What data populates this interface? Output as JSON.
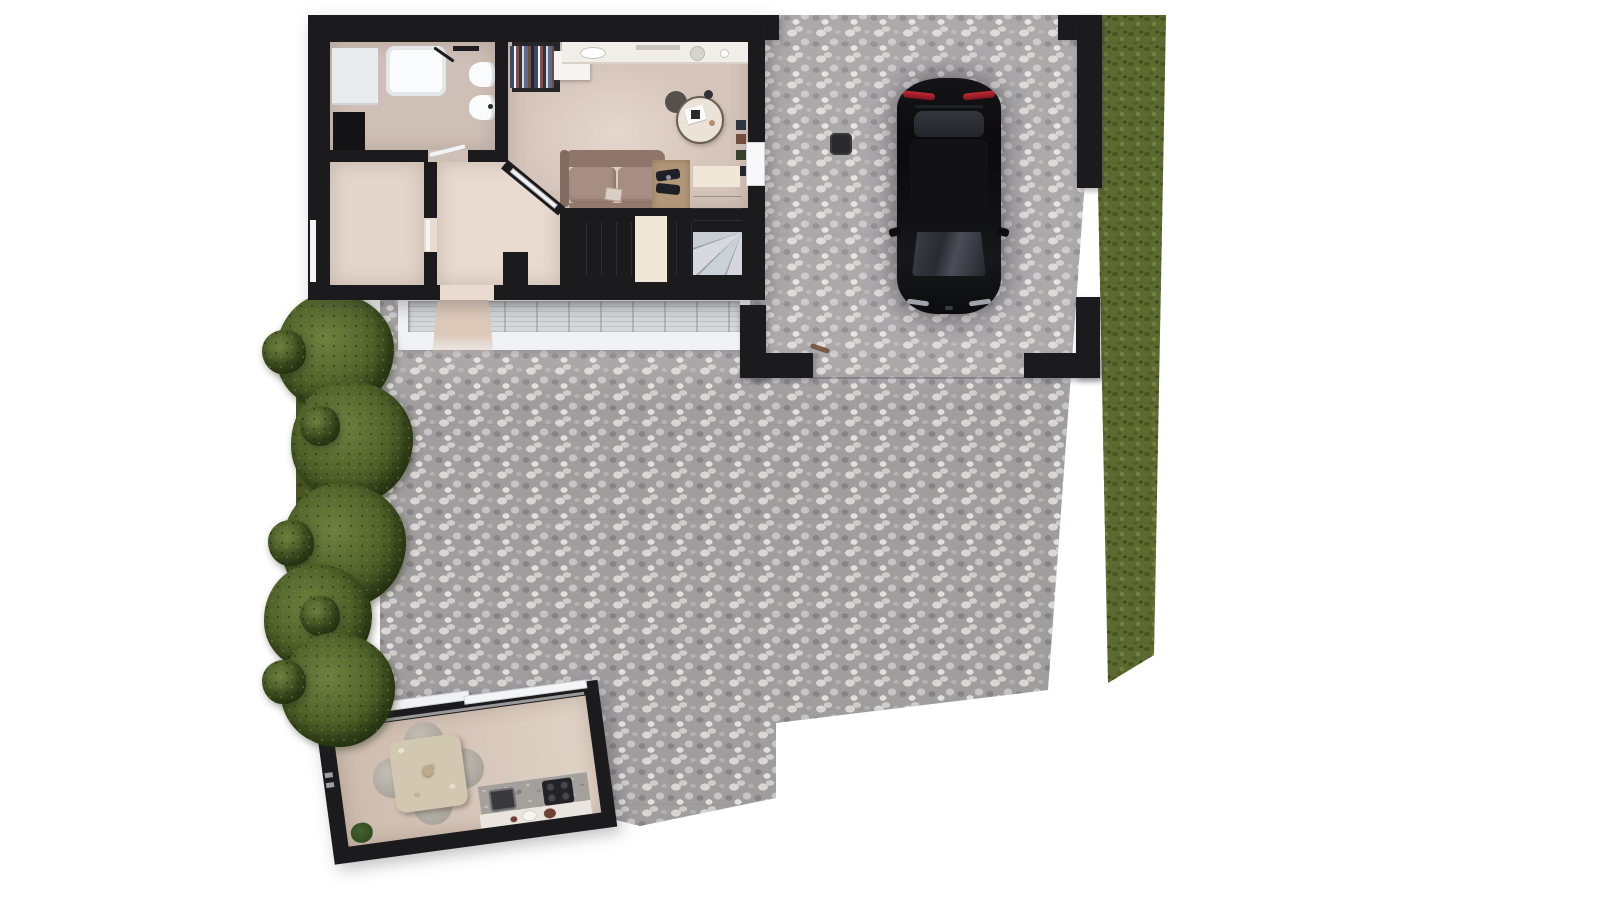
{
  "meta": {
    "kind": "3d-floor-plan-render",
    "view": "top-down",
    "canvas": {
      "width": 1600,
      "height": 900
    },
    "text_content": "none — image contains no visible text, numbers or labels"
  },
  "colors": {
    "background": "#ffffff",
    "wall": "#1b1b1d",
    "bathroomFloor": "#cfc0b7",
    "bedroomFloor": "#e4d6cb",
    "hallFloor": "#e9dbd0",
    "livingFloor": "#d6c5bb",
    "counter": "#f1ede8",
    "sofa": "#a78e83",
    "sofaBack": "#8f766c",
    "wood": "#b2977a",
    "stairLight": "#edeff2",
    "cream": "#f0e7d9",
    "terraceBorder": "#f1f2f3",
    "terraceTile": "#d6d8da",
    "paving": "#a09d9f",
    "pebbleLight": "#d9d7d5",
    "pebbleDark": "#878486",
    "grass": "#5c6a31",
    "grassDark": "#48561f",
    "grassLight": "#73823c",
    "hedge": "#4a5724",
    "bushInner": "#708040",
    "bushOuter": "#32401a",
    "carBody": "#0d0d0f",
    "tailLight": "#b3222e",
    "stoneTable": "#d2c7b0",
    "stoneTable2": "#ece3d8",
    "gardenFloor": "#e0d2c6",
    "kitchenCounter": "#a4a19d",
    "plate": "#f6f4f0",
    "bowl": "#6e4134",
    "pathBeige": "#e0ccbd"
  },
  "scene": {
    "main_house": {
      "rooms": [
        "bathroom",
        "bedroom",
        "hallway",
        "living room",
        "staircase"
      ],
      "bathroom_fixtures": [
        "bathtub with faucet",
        "toilet",
        "bidet",
        "washing machine",
        "dark vanity cabinet",
        "wall shelf"
      ],
      "living_furniture": [
        "kitchen counter with sink",
        "wardrobe with hanging clothes",
        "white island",
        "round side table with papers",
        "two-seat sofa with pillow",
        "wooden dining nook with dark chairs",
        "wall shelf with decor"
      ],
      "staircase": {
        "flights": 2,
        "winder_corner": true,
        "cream_landing_boxes": 2
      },
      "openings": [
        "front entrance door",
        "bathroom door",
        "bedroom door",
        "diagonal glass door to living room",
        "side window to carport"
      ]
    },
    "carport": {
      "corner_pillars": 4,
      "floor": "cobblestone",
      "drain_cover": 1,
      "car": {
        "color": "black",
        "type": "sedan, parked vertically",
        "details": [
          "red taillight strips",
          "rear window",
          "roof",
          "windshield",
          "side mirrors",
          "front highlights"
        ]
      }
    },
    "outdoor": {
      "terrace": {
        "finish": "grey tiles with white border",
        "doormat_path": true
      },
      "paved_courtyard": "cobble pattern with step-shaped lower boundary",
      "lawn_strip": "right edge, tapering toward bottom",
      "hedge_strip": 1,
      "conifer_bushes": 5,
      "small_bushes": 5
    },
    "garden_room": {
      "rotation_deg": -7.7,
      "glass_sliding_door_panels": 2,
      "furniture": [
        "square stone dining table",
        "4 round chairs",
        "kitchenette counter",
        "dark sink",
        "induction hob",
        "plates and bowls",
        "potted plant",
        "door handle"
      ]
    }
  }
}
